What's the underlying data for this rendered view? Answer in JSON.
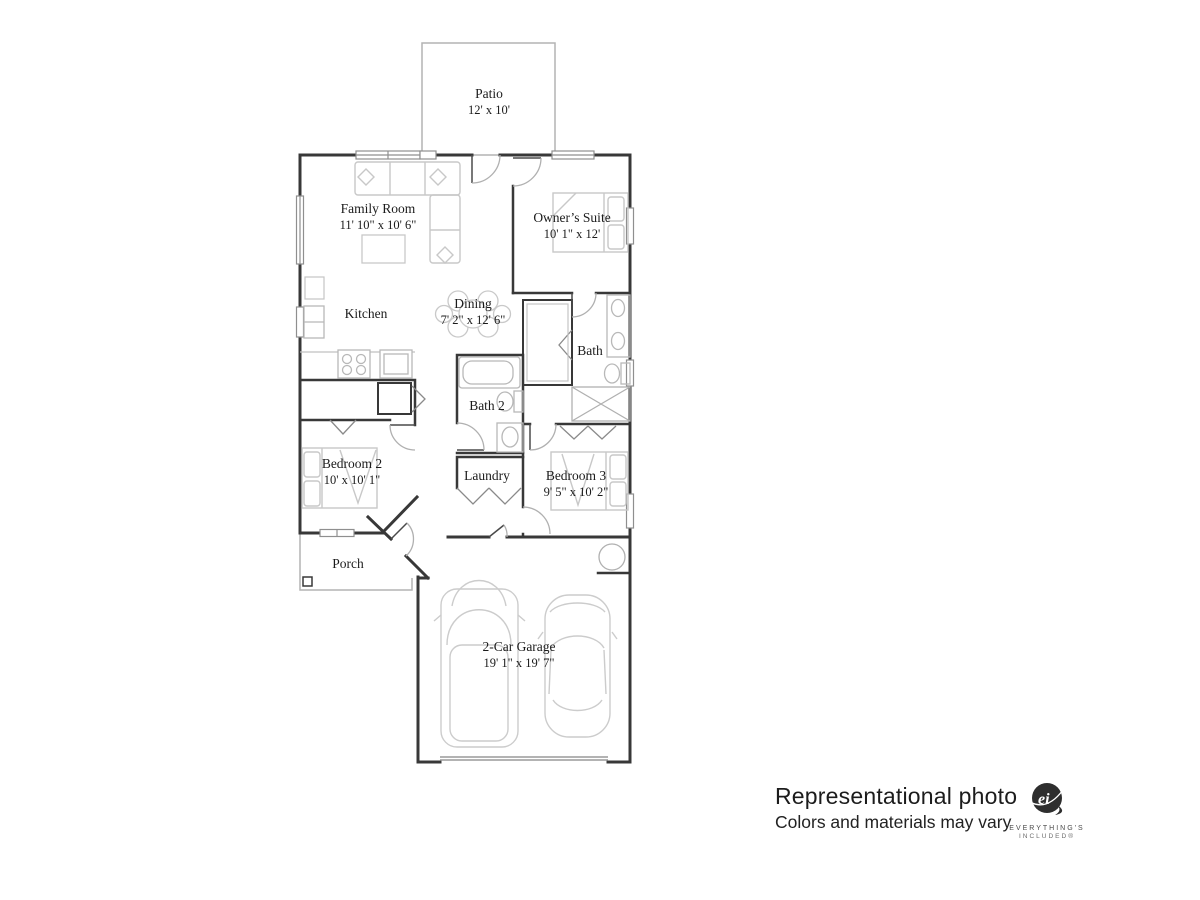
{
  "floorplan": {
    "rooms": [
      {
        "name": "Patio",
        "dims": "12' x 10'"
      },
      {
        "name": "Family Room",
        "dims": "11' 10\" x 10' 6\""
      },
      {
        "name": "Owner’s Suite",
        "dims": "10' 1\" x 12'"
      },
      {
        "name": "Kitchen",
        "dims": ""
      },
      {
        "name": "Dining",
        "dims": "7' 2\" x 12' 6\""
      },
      {
        "name": "Bath",
        "dims": ""
      },
      {
        "name": "Bath 2",
        "dims": ""
      },
      {
        "name": "Bedroom 2",
        "dims": "10' x 10' 1\""
      },
      {
        "name": "Laundry",
        "dims": ""
      },
      {
        "name": "Bedroom 3",
        "dims": "9' 5\" x 10' 2\""
      },
      {
        "name": "Porch",
        "dims": ""
      },
      {
        "name": "2-Car Garage",
        "dims": "19' 1\" x 19' 7\""
      }
    ]
  },
  "disclaimer": {
    "line1": "Representational photo",
    "line2": "Colors and materials may vary"
  },
  "logo": {
    "monogram": "ei",
    "tagline1": "EVERYTHING'S",
    "tagline2": "INCLUDED®"
  },
  "colors": {
    "wall": "#383838",
    "furniture": "#c8c8c8",
    "fixture": "#b8b8b8",
    "text": "#1b1b1b"
  }
}
